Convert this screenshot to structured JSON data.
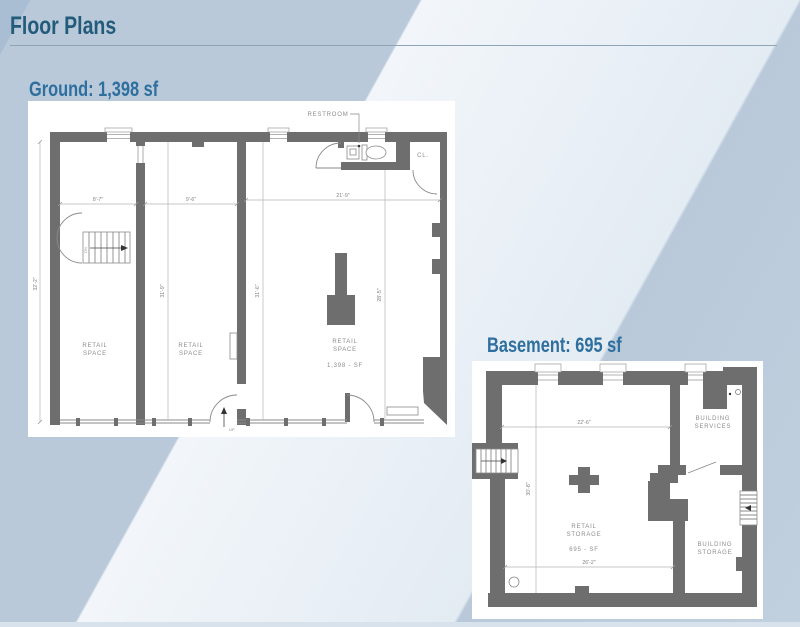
{
  "page": {
    "title": "Floor Plans"
  },
  "ground": {
    "heading": "Ground: 1,398 sf",
    "labels": {
      "restroom": "RESTROOM",
      "closet": "CL.",
      "up": "UP",
      "dn": "DN"
    },
    "rooms": {
      "retail": "RETAIL",
      "space": "SPACE",
      "area": "1,398 - SF"
    },
    "dims": {
      "w_left": "8'-7\"",
      "w_mid": "9'-6\"",
      "w_right": "21'-9\"",
      "h_left": "32'-2\"",
      "h_mid1": "31'-9\"",
      "h_mid2": "31'-6\"",
      "h_right": "28'-5\""
    }
  },
  "basement": {
    "heading": "Basement: 695 sf",
    "rooms": {
      "building": "BUILDING",
      "services": "SERVICES",
      "retail": "RETAIL",
      "storage": "STORAGE",
      "area": "695 - SF"
    },
    "dims": {
      "w_top": "22'-6\"",
      "w_bottom": "26'-2\"",
      "h_left": "30'-8\""
    }
  },
  "colors": {
    "title": "#235b7a",
    "heading": "#2e6f9e",
    "rule": "#8fa5b6",
    "wall": "#6e6e6e",
    "band_light": "#edf2f8",
    "band_medium": "#b9c9da",
    "plan_background": "#ffffff"
  }
}
